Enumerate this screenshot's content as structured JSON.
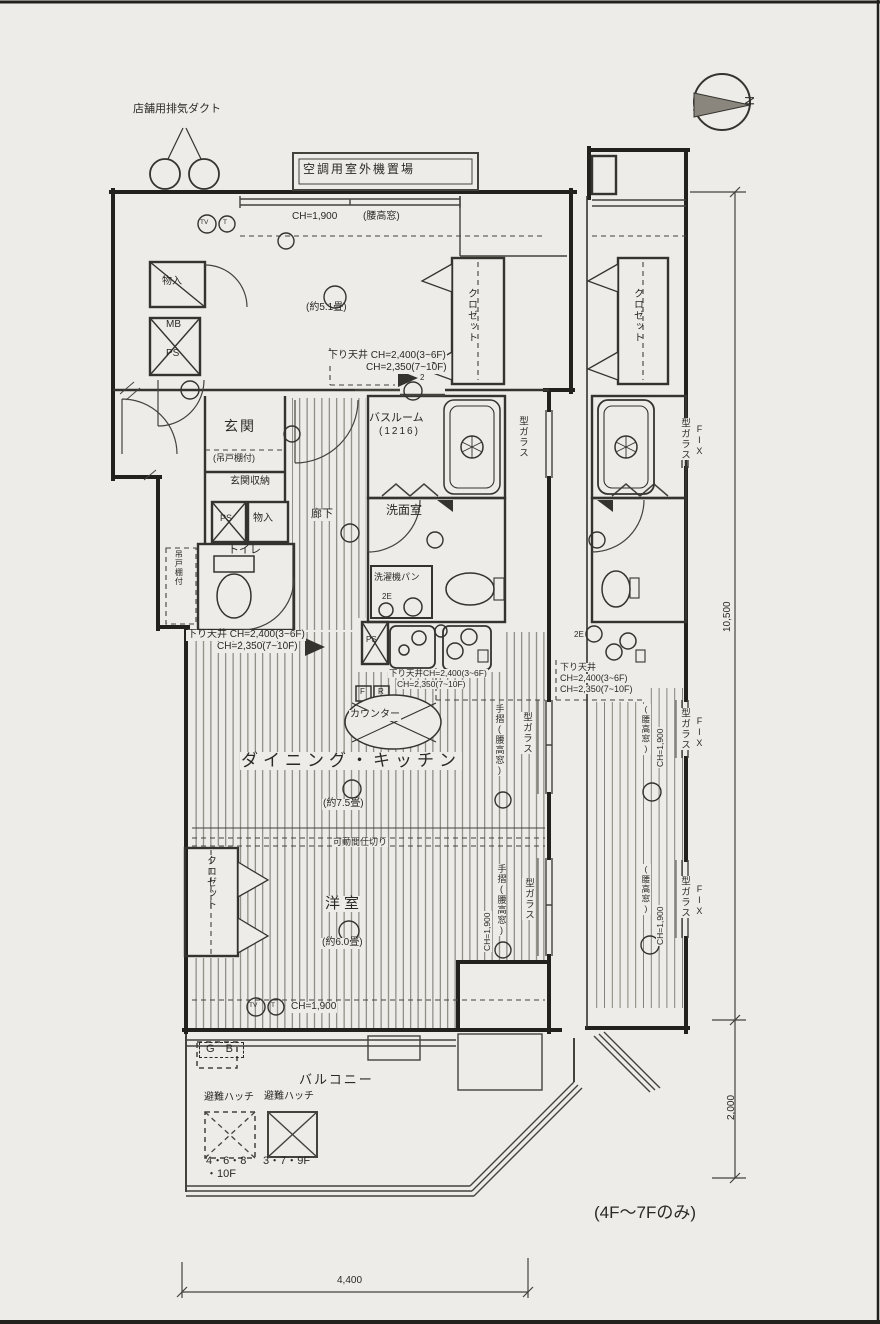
{
  "scan": {
    "paper": "#edece8",
    "ink": "#35332e"
  },
  "compass": {
    "n": "N"
  },
  "dims": {
    "v_main": "10,500",
    "v_balcony": "2,000",
    "h_bottom": "4,400"
  },
  "notes": {
    "floors_only": "(4F～7Fのみ)"
  },
  "top": {
    "duct": "店舗用排気ダクト",
    "ac": "空調用室外機置場",
    "ch": "CH=1,900",
    "mado": "(腰高窓)",
    "tv": "TV",
    "t": "T"
  },
  "room51": {
    "size": "(約5.1畳)",
    "monoire": "物入",
    "mb": "MB",
    "ps": "PS",
    "closet": "クロゼット",
    "door_num": "2"
  },
  "sagari": {
    "label": "下り天井",
    "line1": "下り天井 CH=2,400(3~6F)",
    "line1b": "下り天井CH=2,400(3~6F)",
    "ch_a": "CH=2,400(3~6F)",
    "ch_b": "CH=2,350(7~10F)"
  },
  "entry": {
    "genkan": "玄関",
    "tsuridotana": "(吊戸棚付)",
    "shuno": "玄関収納",
    "ps": "PS",
    "monoire": "物入",
    "rouka": "廊下",
    "toire": "トイレ",
    "tsuridotana_v": "吊戸棚付"
  },
  "wet": {
    "bath": "バスルーム",
    "bath_size": "(1216)",
    "senmen": "洗面室",
    "pan": "洗濯機パン",
    "outlet": "2E"
  },
  "kitchen": {
    "counter": "カウンター",
    "f": "F",
    "r": "R",
    "ps": "PS"
  },
  "dk": {
    "name": "ダイニング・キッチン",
    "size": "(約7.5畳)",
    "partition": "可動間仕切り"
  },
  "yoshitsu": {
    "name": "洋室",
    "size": "(約6.0畳)",
    "ch": "CH=1,900"
  },
  "windows": {
    "tesuri": "手摺(腰高窓)",
    "kata": "型ガラス",
    "fix": "FIX",
    "koshimado": "(腰高窓)",
    "ch": "CH=1,900"
  },
  "balcony": {
    "name": "バルコニー",
    "gb": "G B",
    "hatch": "避難ハッチ",
    "floors_a1": "4・6・8",
    "floors_a2": "・10F",
    "floors_b": "3・7・9F"
  }
}
